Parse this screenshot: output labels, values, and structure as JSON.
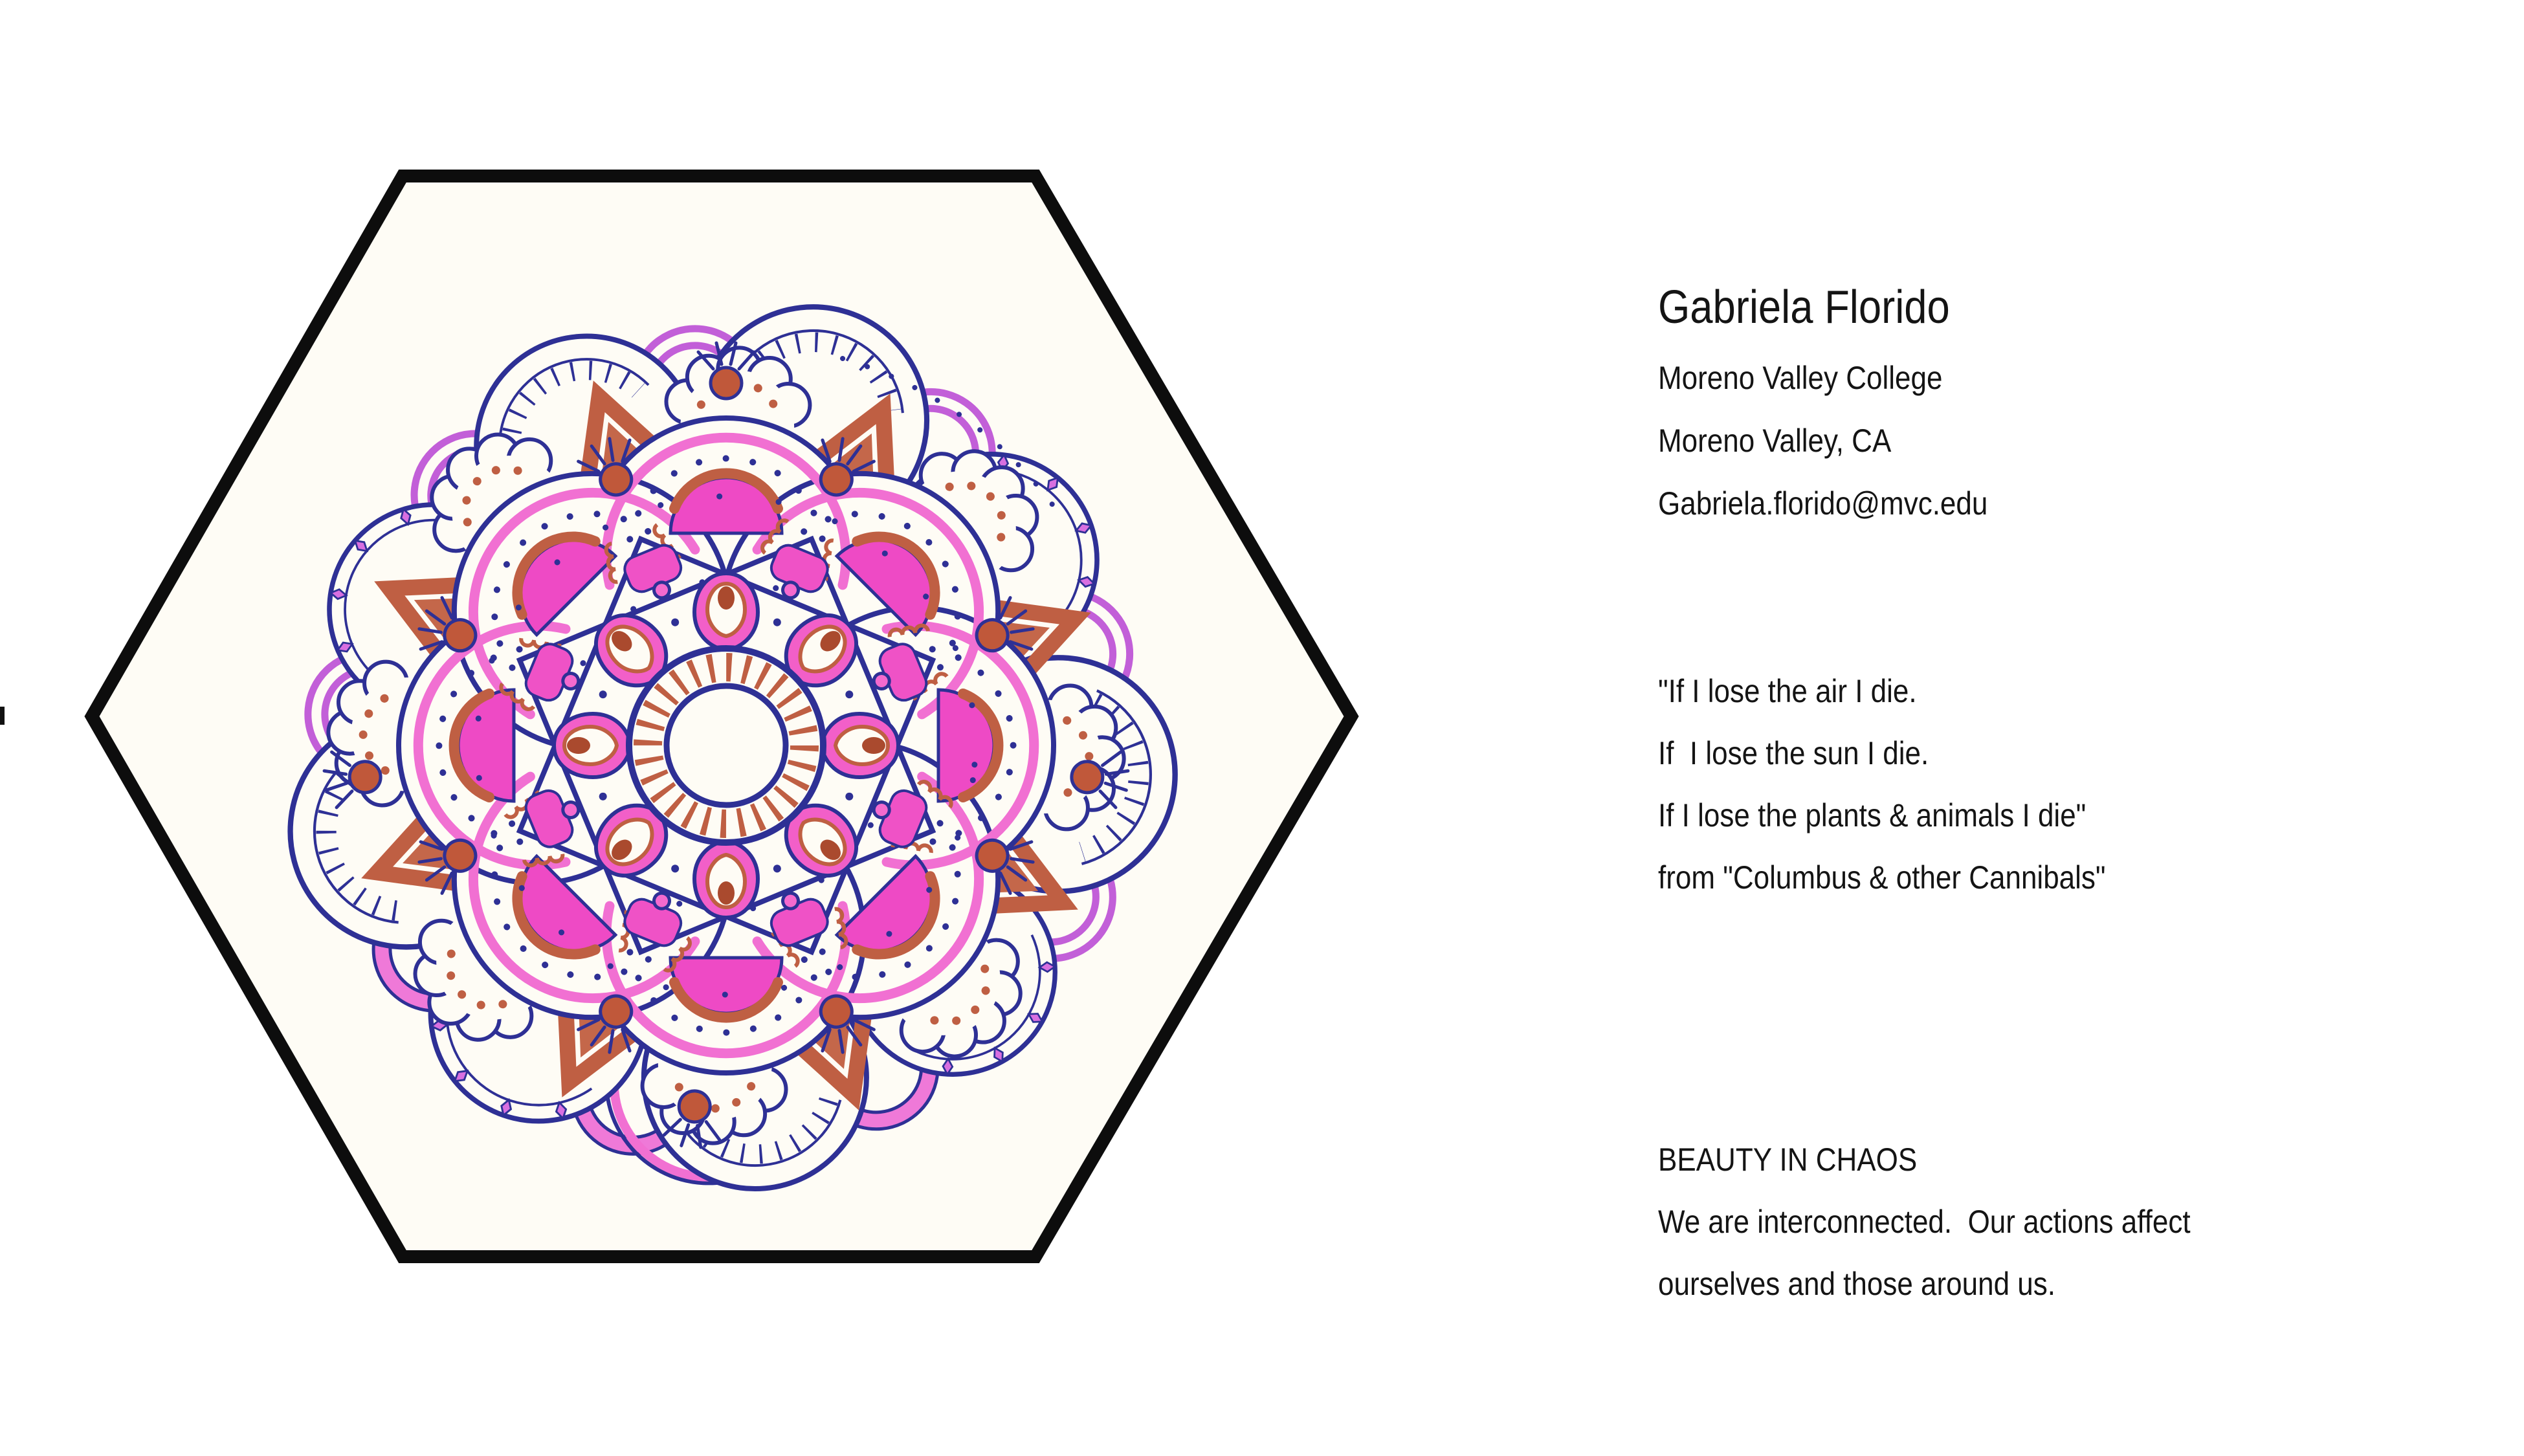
{
  "artist": {
    "name": "Gabriela Florido",
    "college": "Moreno Valley College",
    "city": "Moreno Valley, CA",
    "email": "Gabriela.florido@mvc.edu"
  },
  "quote": {
    "lines": [
      "\"If I lose the air I die.",
      "If  I lose the sun I die.",
      "If I lose the plants & animals I die\"",
      "from \"Columbus & other Cannibals\""
    ]
  },
  "statement": {
    "title": "BEAUTY IN CHAOS",
    "lines": [
      "We are interconnected.  Our actions affect",
      "ourselves and those around us."
    ]
  },
  "artwork": {
    "description": "hand-drawn mandala inside black hexagonal frame",
    "frame_color": "#0d0d0d",
    "paper_color": "#fefcf5",
    "ink_navy": "#2e3095",
    "ink_pink": "#f170d2",
    "ink_magenta": "#ee4ac5",
    "ink_pink_fill": "#f25fc8",
    "ink_terracotta": "#bf5f43",
    "ink_terracotta_dark": "#aa4a2e",
    "ink_violet": "#c25fd8"
  }
}
